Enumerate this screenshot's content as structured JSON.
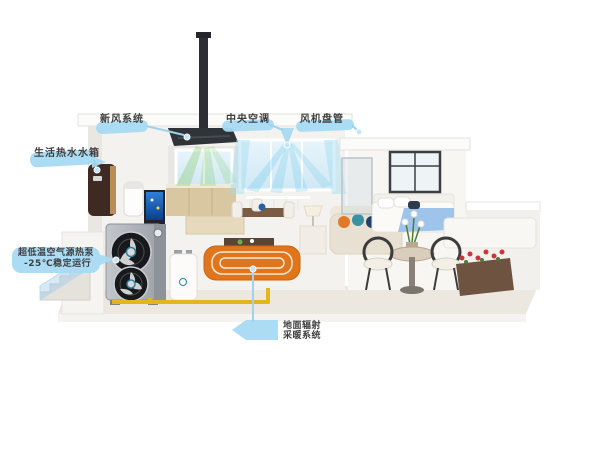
{
  "callouts": {
    "fresh_air": {
      "label": "新风系统"
    },
    "central_ac": {
      "label": "中央空调"
    },
    "fan_coil": {
      "label": "风机盘管"
    },
    "hot_water_tank": {
      "label": "生活热水水箱"
    },
    "heat_pump": {
      "line1": "超低温空气源热泵",
      "line2": "-25℃稳定运行"
    },
    "floor_heating": {
      "line1": "地面辐射",
      "line2": "采暖系统"
    }
  },
  "colors": {
    "callout_blue": "#a8daf3",
    "leader_blue": "#9fd2ef",
    "text_dark": "#3f3f3f",
    "heating_orange": "#e0751c",
    "pipe_yellow": "#e2b61e",
    "fresh_air_green": "#7cc85a",
    "cool_air_cyan": "#78cdeb"
  }
}
